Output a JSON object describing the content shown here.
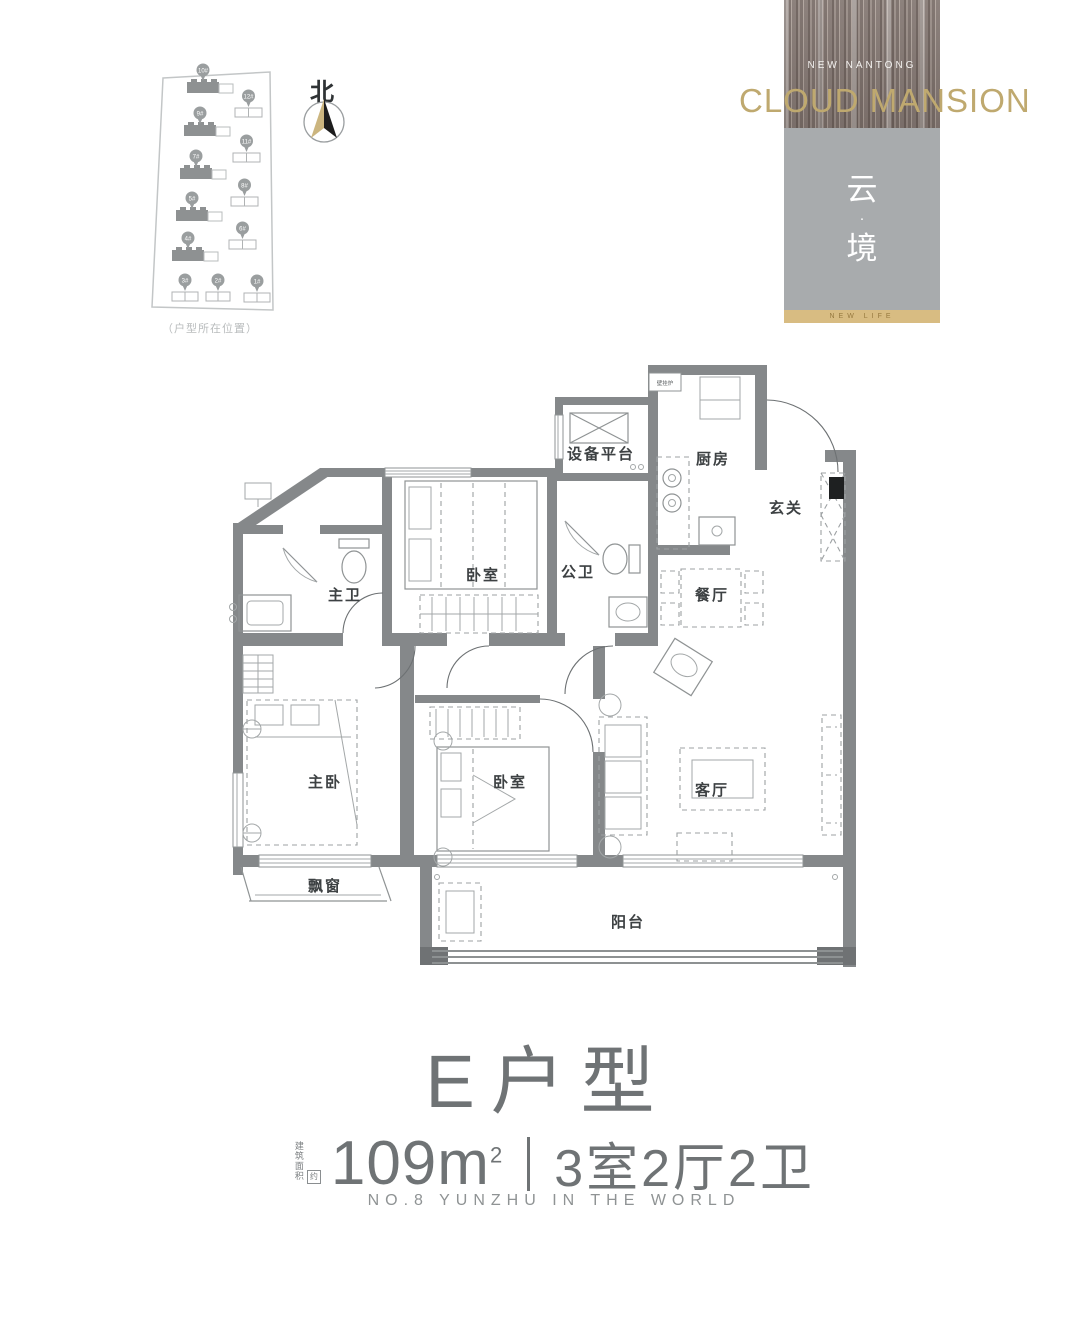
{
  "site_plan": {
    "caption": "（户型所在位置）",
    "compass_label": "北",
    "buildings": [
      {
        "label": "10#",
        "x": 47,
        "y": 27,
        "w": 32,
        "h": 11,
        "dark": true,
        "tail": 14
      },
      {
        "label": "9#",
        "x": 44,
        "y": 70,
        "w": 32,
        "h": 11,
        "dark": true,
        "tail": 14
      },
      {
        "label": "7#",
        "x": 40,
        "y": 113,
        "w": 32,
        "h": 11,
        "dark": true,
        "tail": 14
      },
      {
        "label": "5#",
        "x": 36,
        "y": 155,
        "w": 32,
        "h": 11,
        "dark": true,
        "tail": 14
      },
      {
        "label": "4#",
        "x": 32,
        "y": 195,
        "w": 32,
        "h": 11,
        "dark": true,
        "tail": 14
      },
      {
        "label": "12#",
        "x": 95,
        "y": 53,
        "w": 27,
        "h": 9,
        "dark": false,
        "tail": 0
      },
      {
        "label": "11#",
        "x": 93,
        "y": 98,
        "w": 27,
        "h": 9,
        "dark": false,
        "tail": 0
      },
      {
        "label": "8#",
        "x": 91,
        "y": 142,
        "w": 27,
        "h": 9,
        "dark": false,
        "tail": 0
      },
      {
        "label": "6#",
        "x": 89,
        "y": 185,
        "w": 27,
        "h": 9,
        "dark": false,
        "tail": 0
      },
      {
        "label": "3#",
        "x": 32,
        "y": 237,
        "w": 26,
        "h": 9,
        "dark": false,
        "tail": 0
      },
      {
        "label": "2#",
        "x": 66,
        "y": 237,
        "w": 24,
        "h": 9,
        "dark": false,
        "tail": 0
      },
      {
        "label": "1#",
        "x": 104,
        "y": 238,
        "w": 26,
        "h": 9,
        "dark": false,
        "tail": 0
      }
    ]
  },
  "logo": {
    "subtitle": "NEW NANTONG",
    "title": "CLOUD MANSION",
    "seal_char_1": "云",
    "seal_dot": "·",
    "seal_char_2": "境",
    "banner": "NEW LIFE"
  },
  "floor_plan": {
    "rooms": [
      {
        "id": "equipment-platform",
        "name": "设备平台"
      },
      {
        "id": "kitchen",
        "name": "厨房"
      },
      {
        "id": "foyer",
        "name": "玄关"
      },
      {
        "id": "public-bath",
        "name": "公卫"
      },
      {
        "id": "bedroom-north",
        "name": "卧室"
      },
      {
        "id": "master-bath",
        "name": "主卫"
      },
      {
        "id": "dining-room",
        "name": "餐厅"
      },
      {
        "id": "master-bedroom",
        "name": "主卧"
      },
      {
        "id": "bedroom-south",
        "name": "卧室"
      },
      {
        "id": "living-room",
        "name": "客厅"
      },
      {
        "id": "bay-window",
        "name": "飘窗"
      },
      {
        "id": "balcony",
        "name": "阳台"
      }
    ],
    "boiler_label": "壁挂炉"
  },
  "title_block": {
    "unit_title": "E户型",
    "area_prefix": "建筑面积",
    "area_prefix_box": "约",
    "area_value": "109m",
    "area_sup": "2",
    "layout_spec": "3室2厅2卫",
    "tagline": "NO.8 YUNZHU IN THE WORLD"
  },
  "colors": {
    "accent_gold": "#bfa96f",
    "gold_bar": "#d8bc82",
    "seal_gray": "#a8abad",
    "wall_gray": "#85888a",
    "title_gray": "#6f7375"
  }
}
